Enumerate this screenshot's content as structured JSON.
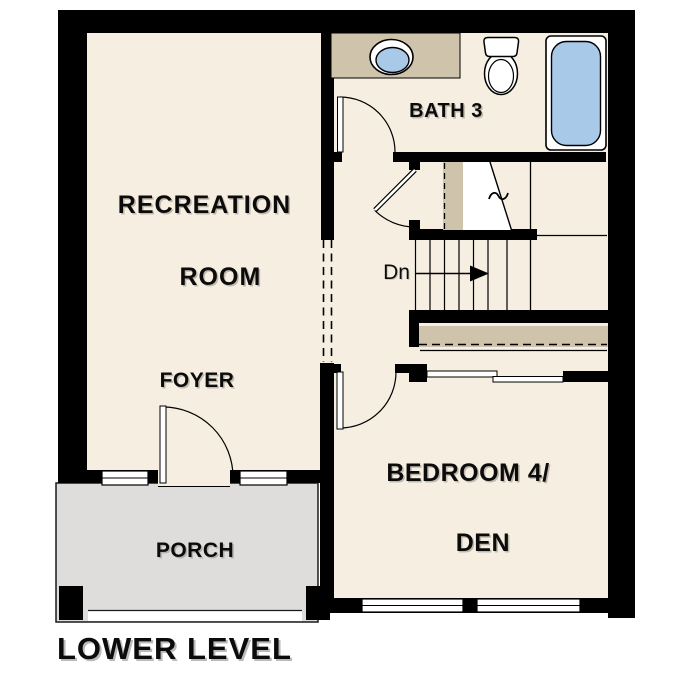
{
  "title": "LOWER LEVEL",
  "rooms": {
    "recreation": {
      "line1": "RECREATION",
      "line2": "ROOM"
    },
    "foyer": {
      "label": "FOYER"
    },
    "bath": {
      "label": "BATH 3"
    },
    "bedroom": {
      "line1": "BEDROOM 4/",
      "line2": "DEN"
    },
    "porch": {
      "label": "PORCH"
    }
  },
  "stairs": {
    "direction_label": "Dn"
  },
  "fixtures": [
    "vanity-sink",
    "toilet",
    "bathtub"
  ],
  "colors": {
    "wall": "#000000",
    "floor_cream": "#f6eee1",
    "counter_tan": "#cfc4ab",
    "fixture_blue": "#a9c9e9",
    "porch_gray": "#dedddc",
    "outline": "#1a1a1a"
  }
}
